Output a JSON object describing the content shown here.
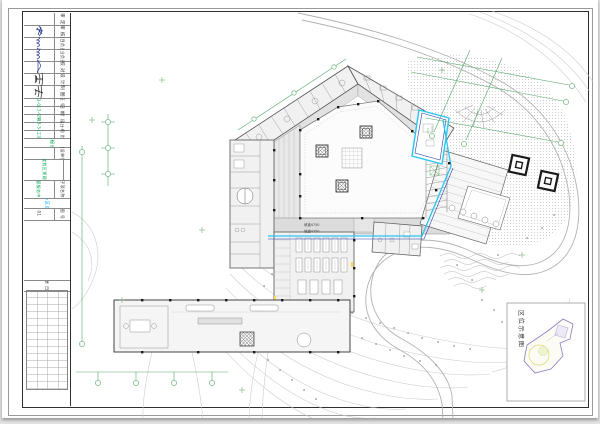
{
  "title_block": {
    "sign_rows": [
      {
        "label": "审 定"
      },
      {
        "label": "审 核"
      },
      {
        "label": "项目负责"
      },
      {
        "label": "专业负责"
      },
      {
        "label": "校 对"
      },
      {
        "label": "设 计"
      },
      {
        "label": "制 图"
      }
    ],
    "info_rows": [
      {
        "label": "证 号",
        "value": "02-13-0182"
      },
      {
        "label": "日 期",
        "value": "2013-04"
      },
      {
        "label": "阶 段",
        "value": "2期"
      },
      {
        "label": "设计号",
        "value": "13-54"
      },
      {
        "label": "图 别",
        "value": "施工图"
      }
    ],
    "stamp_line": "风景园林工程设计专用章",
    "unit_label": "建设单位",
    "project_label": "工程名称",
    "project_value": "温泉度假区景观工程",
    "subitem_label": "子项名称",
    "subitem_value": "游客服务中心",
    "drawing_title": "服务中心区总平面图",
    "drawing_no_label": "图 号",
    "drawing_no_value": "01",
    "rev_header": "修改记录 日期 签名"
  },
  "plan": {
    "ramp_label_1": "坡道4750",
    "ramp_label_2": "坡道4750",
    "inset_label": "区位示意图"
  },
  "colors": {
    "grid_green": "#54a868",
    "text_green": "#00a651",
    "cyan": "#29c5f2",
    "deep_blue": "#2a3fa0",
    "signature_blue": "#2b3990"
  }
}
